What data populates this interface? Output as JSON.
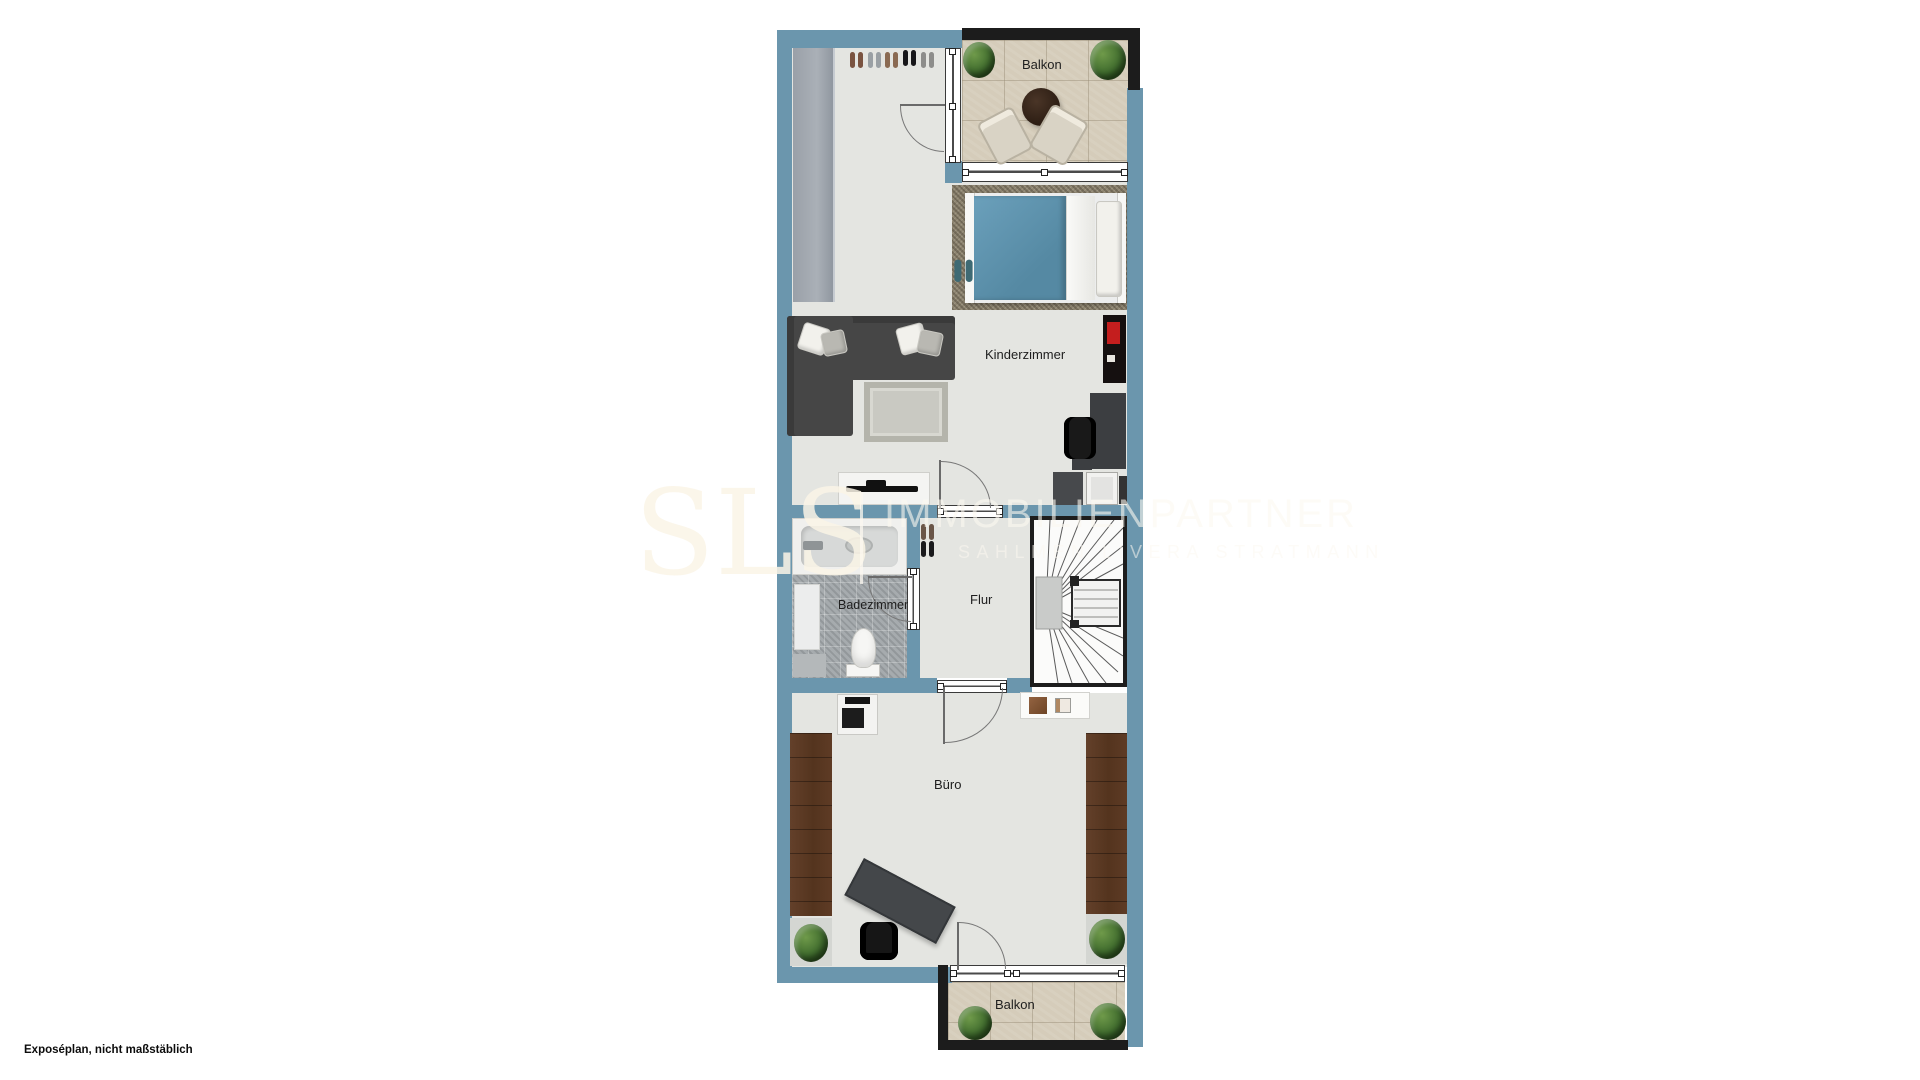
{
  "caption": "Exposéplan, nicht maßstäblich",
  "watermark": {
    "logo": "SLS",
    "brand": "IMMOBILIENPARTNER",
    "subtitle": "SAHLMEN LIVERA STRATMANN"
  },
  "rooms": {
    "balkon_top": {
      "label": "Balkon"
    },
    "kinderzimmer": {
      "label": "Kinderzimmer"
    },
    "badezimmer": {
      "label": "Badezimmer"
    },
    "flur": {
      "label": "Flur"
    },
    "buero": {
      "label": "Büro"
    },
    "balkon_bottom": {
      "label": "Balkon"
    }
  },
  "colors": {
    "wall": "#6b96ad",
    "outer_wall_dark": "#1c1c1c",
    "floor": "#e4e5e1",
    "balcony_floor": "#d5ccba",
    "bath_floor": "#a6abae",
    "bed_blanket": "#5f93ad",
    "furniture_dark": "#454749",
    "wood": "#5a3a27",
    "accent_red": "#c41e1e",
    "watermark": "#f7f1e6"
  }
}
